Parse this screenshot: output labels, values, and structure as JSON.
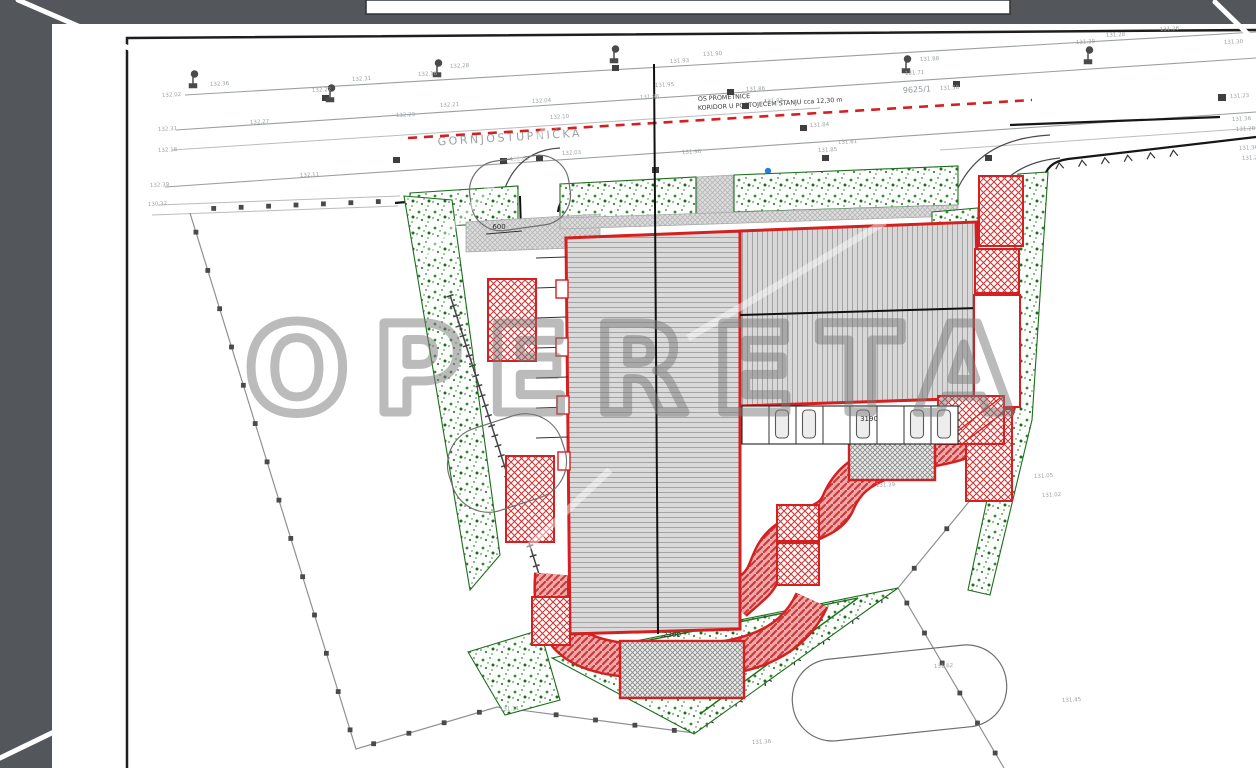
{
  "scene": {
    "surround_color": "#53575b",
    "paper_color": "#ffffff"
  },
  "watermark": {
    "text": "OPERETA"
  },
  "road": {
    "street_name": "GORNJOSTUPNIČKA",
    "axis_label_line1": "OS PROMETNICE",
    "axis_label_line2": "KORIDOR U POSTOJEĆEM STANJU cca 12,30 m",
    "parcel_number": "9625/1"
  },
  "dimensions": {
    "entrance": "600",
    "building_front": "2300",
    "parking_row": "3190"
  },
  "colors": {
    "plan_red": "#d42020",
    "landscape_green": "#1c6e1c",
    "roof_hatch": "#9b9b9b",
    "survey_gray": "#9aa0a2"
  },
  "elevations": [
    {
      "v": "132.02",
      "x": 162,
      "y": 97
    },
    {
      "v": "132.36",
      "x": 210,
      "y": 86
    },
    {
      "v": "132.22",
      "x": 312,
      "y": 92
    },
    {
      "v": "132.31",
      "x": 352,
      "y": 81
    },
    {
      "v": "132.16",
      "x": 418,
      "y": 76
    },
    {
      "v": "132.28",
      "x": 450,
      "y": 68
    },
    {
      "v": "132.31",
      "x": 158,
      "y": 131
    },
    {
      "v": "132.18",
      "x": 158,
      "y": 152
    },
    {
      "v": "132.27",
      "x": 250,
      "y": 124
    },
    {
      "v": "132.23",
      "x": 396,
      "y": 117
    },
    {
      "v": "132.21",
      "x": 440,
      "y": 107
    },
    {
      "v": "132.04",
      "x": 532,
      "y": 103
    },
    {
      "v": "132.10",
      "x": 550,
      "y": 119
    },
    {
      "v": "132.03",
      "x": 562,
      "y": 155
    },
    {
      "v": "132.01",
      "x": 510,
      "y": 161
    },
    {
      "v": "131.98",
      "x": 640,
      "y": 99
    },
    {
      "v": "131.95",
      "x": 655,
      "y": 87
    },
    {
      "v": "131.93",
      "x": 670,
      "y": 63
    },
    {
      "v": "131.90",
      "x": 703,
      "y": 56
    },
    {
      "v": "131.86",
      "x": 746,
      "y": 91
    },
    {
      "v": "131.83",
      "x": 764,
      "y": 103
    },
    {
      "v": "131.84",
      "x": 810,
      "y": 127
    },
    {
      "v": "131.81",
      "x": 838,
      "y": 144
    },
    {
      "v": "131.88",
      "x": 920,
      "y": 61
    },
    {
      "v": "131.71",
      "x": 905,
      "y": 75
    },
    {
      "v": "131.58",
      "x": 940,
      "y": 90
    },
    {
      "v": "131.38",
      "x": 1076,
      "y": 44
    },
    {
      "v": "131.28",
      "x": 1106,
      "y": 37
    },
    {
      "v": "131.26",
      "x": 1160,
      "y": 31
    },
    {
      "v": "131.30",
      "x": 1224,
      "y": 44
    },
    {
      "v": "131.23",
      "x": 1230,
      "y": 98
    },
    {
      "v": "131.36",
      "x": 1232,
      "y": 121
    },
    {
      "v": "131.28",
      "x": 1236,
      "y": 131
    },
    {
      "v": "131.36",
      "x": 1239,
      "y": 150
    },
    {
      "v": "131.27",
      "x": 1242,
      "y": 160
    },
    {
      "v": "132.39",
      "x": 150,
      "y": 187
    },
    {
      "v": "130.32",
      "x": 148,
      "y": 206
    },
    {
      "v": "132.11",
      "x": 300,
      "y": 177
    },
    {
      "v": "131.96",
      "x": 682,
      "y": 154
    },
    {
      "v": "131.85",
      "x": 818,
      "y": 152
    },
    {
      "v": "131.39",
      "x": 876,
      "y": 487
    },
    {
      "v": "131.05",
      "x": 1034,
      "y": 478
    },
    {
      "v": "131.02",
      "x": 1042,
      "y": 497
    },
    {
      "v": "131.62",
      "x": 934,
      "y": 668
    },
    {
      "v": "131.45",
      "x": 1062,
      "y": 702
    },
    {
      "v": "131.36",
      "x": 752,
      "y": 744
    },
    {
      "v": "131.11",
      "x": 500,
      "y": 711
    }
  ]
}
